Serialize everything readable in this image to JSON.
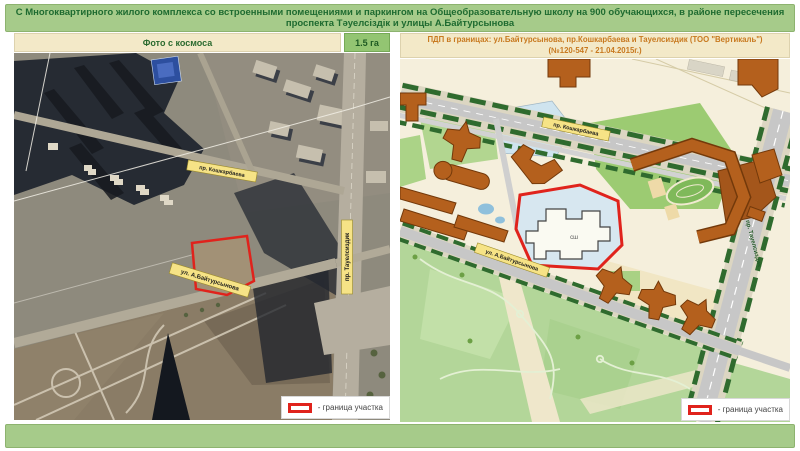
{
  "title": {
    "line1": "С Многоквартирного жилого комплекса со встроенными помещениями и паркингом на Общеобразовательную школу на 900 обучающихся, в районе пересечения",
    "line2": "проспекта Тәуелсіздік и улицы А.Байтурсынова"
  },
  "colors": {
    "bar_green": "#a6cb8a",
    "title_text": "#1e6b30",
    "header_beige": "#f3e9c8",
    "right_header_text": "#c8791f",
    "badge_green": "#93c572",
    "boundary_red": "#e0231c",
    "street_label_yellow": "#f6e386"
  },
  "left_panel": {
    "header": "Фото с космоса",
    "area_badge": "1.5 га",
    "labels": {
      "koshkarbaeva": "пр. Кошкарбаева",
      "baitursynova": "ул. А.Байтурсынова",
      "tauelsizdik": "пр. Тауелсиздик"
    },
    "legend": "- граница участка"
  },
  "right_panel": {
    "header_line1": "ПДП в границах: ул.Байтурсынова, пр.Кошкарбаева и Тауелсиздик (ТОО \"Вертикаль\")",
    "header_line2": "(№120-547 - 21.04.2015г.)",
    "labels": {
      "koshkarbaeva": "пр. Кошкарбаева",
      "baitursynova": "ул. А.Байтурсынова",
      "tauelsizdik": "пр. Тауелсиздик"
    },
    "school": "сш",
    "legend": "- граница участка"
  }
}
